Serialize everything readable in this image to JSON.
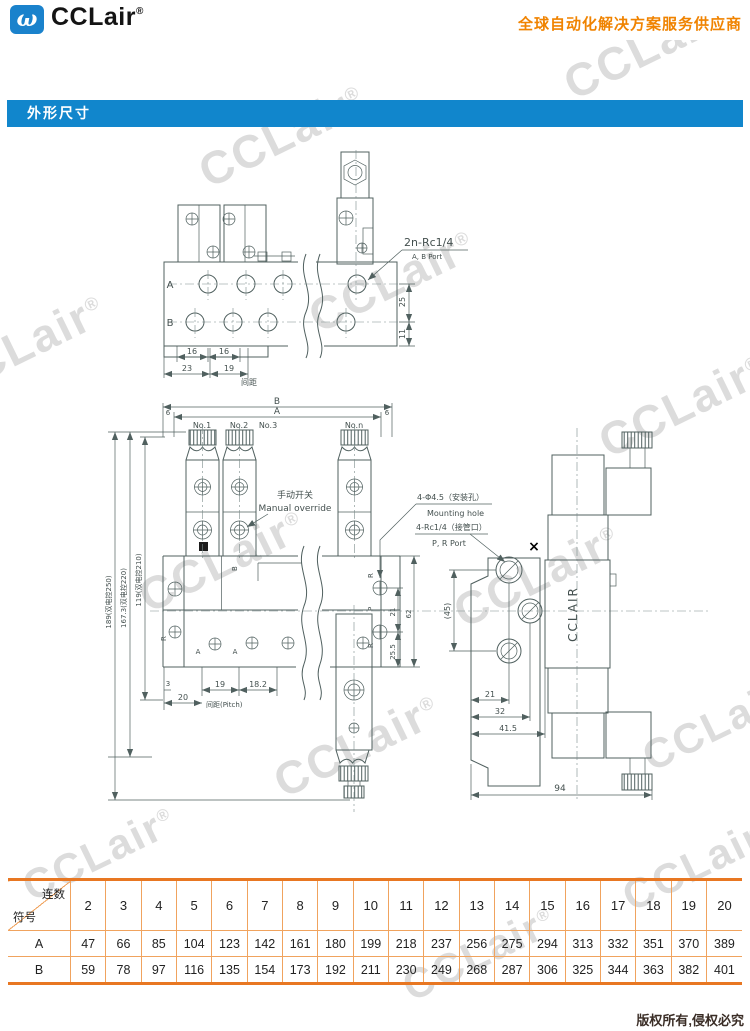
{
  "header": {
    "brand": "CCLair",
    "reg": "®",
    "logo_glyph": "ω",
    "tagline": "全球自动化解决方案服务供应商"
  },
  "banner": {
    "title": "外形尺寸"
  },
  "watermark": {
    "text": "CCLair",
    "reg": "®"
  },
  "drawing": {
    "top_view": {
      "label_a": "A",
      "label_b": "B",
      "port_callout": "2n-Rc1/4",
      "port_callout_sub": "A, B Port",
      "dim_16a": "16",
      "dim_16b": "16",
      "dim_23": "23",
      "dim_19": "19",
      "pitch_cn": "间距",
      "dim_25": "25",
      "dim_11": "11"
    },
    "front_view": {
      "dim_b": "B",
      "dim_a": "A",
      "dim_6l": "6",
      "dim_6r": "6",
      "stations": [
        "No.1",
        "No.2",
        "No.3",
        "No.n"
      ],
      "manual_cn": "手动开关",
      "manual_en": "Manual override",
      "height_dims": [
        "189(双电控250)",
        "167.3(双电控220)",
        "119(双电控210)"
      ],
      "mount_cn": "4-Φ4.5（安装孔）",
      "mount_en": "Mounting hole",
      "pipe_cn": "4-Rc1/4（接管口）",
      "pipe_en": "P, R Port",
      "label_r_left": "R",
      "label_a1": "A",
      "label_a2": "A",
      "label_b": "B",
      "label_r_top": "R",
      "label_p": "P",
      "label_r_bot": "R",
      "dim_21": "21",
      "dim_25_5": "25.5",
      "dim_62": "62",
      "dim_3": "3",
      "dim_19": "19",
      "dim_18_2": "18.2",
      "dim_20": "20",
      "pitch_label": "间距(Pitch)",
      "marker_x": "×"
    },
    "side_view": {
      "dim_45": "(45)",
      "body_text": "CCLAIR",
      "dim_21": "21",
      "dim_32": "32",
      "dim_41_5": "41.5",
      "dim_94": "94"
    }
  },
  "table": {
    "corner_top": "连数",
    "corner_bottom": "符号",
    "columns": [
      "2",
      "3",
      "4",
      "5",
      "6",
      "7",
      "8",
      "9",
      "10",
      "11",
      "12",
      "13",
      "14",
      "15",
      "16",
      "17",
      "18",
      "19",
      "20"
    ],
    "rows": [
      {
        "label": "A",
        "values": [
          47,
          66,
          85,
          104,
          123,
          142,
          161,
          180,
          199,
          218,
          237,
          256,
          275,
          294,
          313,
          332,
          351,
          370,
          389
        ]
      },
      {
        "label": "B",
        "values": [
          59,
          78,
          97,
          116,
          135,
          154,
          173,
          192,
          211,
          230,
          249,
          268,
          287,
          306,
          325,
          344,
          363,
          382,
          401
        ]
      }
    ]
  },
  "footer": {
    "copyright": "版权所有,侵权必究"
  },
  "colors": {
    "accent_orange": "#f08300",
    "banner_blue": "#1186cc",
    "table_border_orange": "#e87722",
    "drawing_line": "#50605f"
  }
}
